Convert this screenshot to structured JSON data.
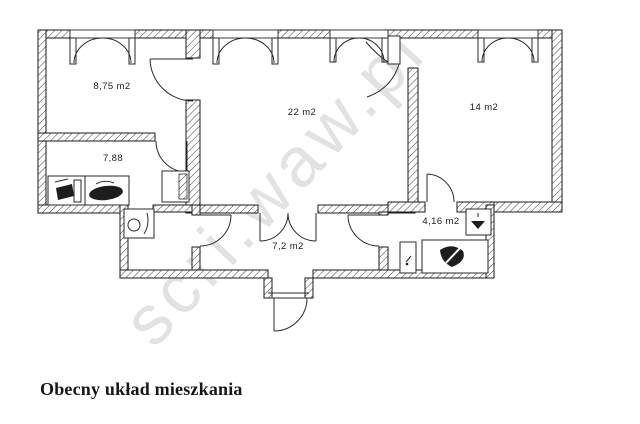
{
  "caption": "Obecny układ mieszkania",
  "watermark": "scri.waw.pl",
  "rooms": [
    {
      "name": "room-top-left",
      "label": "8,75 m2"
    },
    {
      "name": "room-living",
      "label": "22 m2"
    },
    {
      "name": "room-right",
      "label": "14 m2"
    },
    {
      "name": "room-bathroom",
      "label": "7,88"
    },
    {
      "name": "room-hallway",
      "label": "7,2 m2"
    },
    {
      "name": "room-kitchen",
      "label": "4,16 m2"
    }
  ],
  "fixtures": [
    "toilet",
    "bathtub",
    "washbasin",
    "water-heater",
    "fridge",
    "stove",
    "sink"
  ],
  "colors": {
    "line": "#1a1a1a",
    "watermark": "#e2e2e2",
    "background": "#ffffff"
  }
}
